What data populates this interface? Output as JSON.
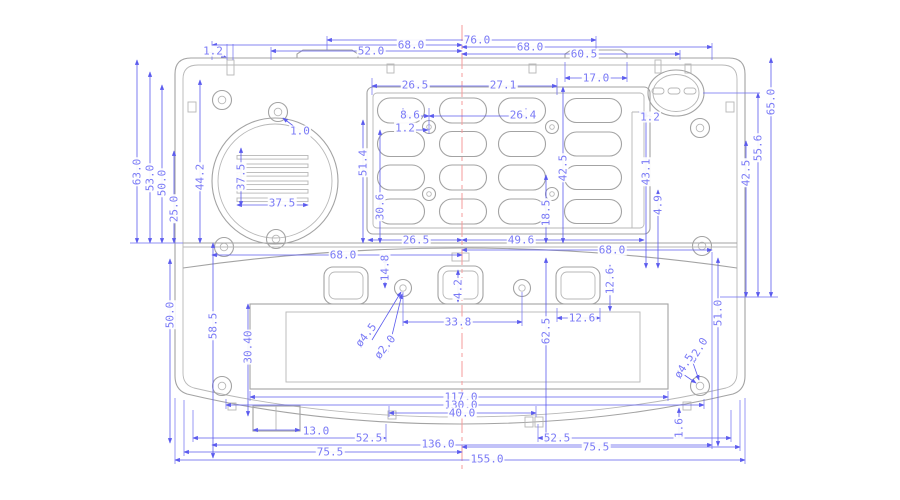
{
  "drawing": {
    "kind": "mechanical-dimension-front-view",
    "units": "mm",
    "colors": {
      "outline": "#a3a3a3",
      "dimension_line": "#5b5bee",
      "dimension_text": "#7a7af6",
      "centerline": "#f49b9b",
      "background": "#ffffff"
    },
    "dimensions": [
      {
        "value": "1.2",
        "x": 213,
        "y": 51,
        "rot": 0
      },
      {
        "value": "52.0",
        "x": 371,
        "y": 51,
        "rot": 0
      },
      {
        "value": "68.0",
        "x": 411,
        "y": 45,
        "rot": 0
      },
      {
        "value": "76.0",
        "x": 477,
        "y": 40,
        "rot": 0
      },
      {
        "value": "68.0",
        "x": 530,
        "y": 47,
        "rot": 0
      },
      {
        "value": "60.5",
        "x": 584,
        "y": 54,
        "rot": 0
      },
      {
        "value": "17.0",
        "x": 596,
        "y": 78,
        "rot": 0
      },
      {
        "value": "26.5",
        "x": 415,
        "y": 85,
        "rot": 0
      },
      {
        "value": "27.1",
        "x": 503,
        "y": 85,
        "rot": 0
      },
      {
        "value": "8.6",
        "x": 410,
        "y": 115,
        "rot": 0
      },
      {
        "value": "26.4",
        "x": 523,
        "y": 115,
        "rot": 0
      },
      {
        "value": "1.2",
        "x": 405,
        "y": 128,
        "rot": 0
      },
      {
        "value": "1.0",
        "x": 300,
        "y": 131,
        "rot": 0
      },
      {
        "value": "63.0",
        "x": 137,
        "y": 172,
        "rot": -90
      },
      {
        "value": "53.0",
        "x": 150,
        "y": 178,
        "rot": -90
      },
      {
        "value": "50.0",
        "x": 162,
        "y": 183,
        "rot": -90
      },
      {
        "value": "25.0",
        "x": 174,
        "y": 209,
        "rot": -90
      },
      {
        "value": "44.2",
        "x": 200,
        "y": 177,
        "rot": -90
      },
      {
        "value": "37.5",
        "x": 241,
        "y": 177,
        "rot": -90
      },
      {
        "value": "37.5",
        "x": 282,
        "y": 203,
        "rot": 0
      },
      {
        "value": "51.4",
        "x": 363,
        "y": 163,
        "rot": -90
      },
      {
        "value": "30.6",
        "x": 380,
        "y": 207,
        "rot": -90
      },
      {
        "value": "42.5",
        "x": 563,
        "y": 168,
        "rot": -90
      },
      {
        "value": "18.5",
        "x": 546,
        "y": 213,
        "rot": -90
      },
      {
        "value": "1.2",
        "x": 650,
        "y": 117,
        "rot": 0
      },
      {
        "value": "43.1",
        "x": 646,
        "y": 172,
        "rot": -90
      },
      {
        "value": "4.9",
        "x": 658,
        "y": 205,
        "rot": -90
      },
      {
        "value": "42.5",
        "x": 746,
        "y": 173,
        "rot": -90
      },
      {
        "value": "55.6",
        "x": 758,
        "y": 148,
        "rot": -90
      },
      {
        "value": "65.0",
        "x": 771,
        "y": 102,
        "rot": -90
      },
      {
        "value": "26.5",
        "x": 416,
        "y": 240,
        "rot": 0
      },
      {
        "value": "49.6",
        "x": 521,
        "y": 240,
        "rot": 0
      },
      {
        "value": "68.0",
        "x": 343,
        "y": 255,
        "rot": 0
      },
      {
        "value": "68.0",
        "x": 612,
        "y": 250,
        "rot": 0
      },
      {
        "value": "14.8",
        "x": 385,
        "y": 268,
        "rot": -90
      },
      {
        "value": "4.2",
        "x": 458,
        "y": 289,
        "rot": -90
      },
      {
        "value": "33.8",
        "x": 458,
        "y": 322,
        "rot": 0
      },
      {
        "value": "ø4.5",
        "x": 366,
        "y": 335,
        "rot": -52
      },
      {
        "value": "ø2.0",
        "x": 385,
        "y": 347,
        "rot": -52
      },
      {
        "value": "12.6",
        "x": 610,
        "y": 281,
        "rot": -90
      },
      {
        "value": "12.6",
        "x": 582,
        "y": 318,
        "rot": 0
      },
      {
        "value": "62.5",
        "x": 546,
        "y": 331,
        "rot": -90
      },
      {
        "value": "51.0",
        "x": 718,
        "y": 313,
        "rot": -90
      },
      {
        "value": "50.0",
        "x": 170,
        "y": 315,
        "rot": -90
      },
      {
        "value": "58.5",
        "x": 213,
        "y": 326,
        "rot": -90
      },
      {
        "value": "30.40",
        "x": 248,
        "y": 347,
        "rot": -90
      },
      {
        "value": "ø2.0",
        "x": 698,
        "y": 350,
        "rot": -58
      },
      {
        "value": "ø4.5",
        "x": 684,
        "y": 366,
        "rot": -58
      },
      {
        "value": "1.6",
        "x": 679,
        "y": 428,
        "rot": -90
      },
      {
        "value": "117.0",
        "x": 461,
        "y": 397,
        "rot": 0
      },
      {
        "value": "130.0",
        "x": 461,
        "y": 405,
        "rot": 0
      },
      {
        "value": "40.0",
        "x": 462,
        "y": 413,
        "rot": 0
      },
      {
        "value": "13.0",
        "x": 316,
        "y": 431,
        "rot": 0
      },
      {
        "value": "52.5",
        "x": 369,
        "y": 438,
        "rot": 0
      },
      {
        "value": "52.5",
        "x": 557,
        "y": 438,
        "rot": 0
      },
      {
        "value": "136.0",
        "x": 438,
        "y": 444,
        "rot": 0
      },
      {
        "value": "75.5",
        "x": 330,
        "y": 452,
        "rot": 0
      },
      {
        "value": "75.5",
        "x": 596,
        "y": 447,
        "rot": 0
      },
      {
        "value": "155.0",
        "x": 487,
        "y": 459,
        "rot": 0
      }
    ]
  }
}
